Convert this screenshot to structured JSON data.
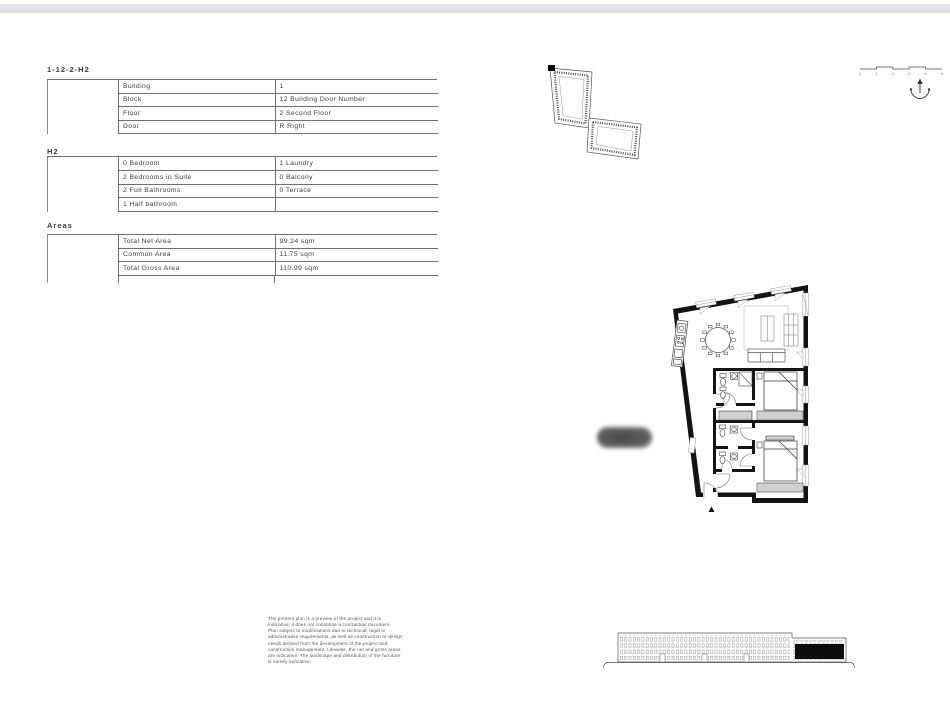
{
  "unit_table": {
    "title": "1-12-2-H2",
    "rows": [
      {
        "label": "Building",
        "value": "1"
      },
      {
        "label": "Block",
        "value": "12 Building Door Number"
      },
      {
        "label": "Floor",
        "value": "2 Second Floor"
      },
      {
        "label": "Door",
        "value": "R Right"
      }
    ]
  },
  "layout_table": {
    "title": "H2",
    "rows": [
      {
        "label": "0 Bedroom",
        "value": "1 Laundry"
      },
      {
        "label": "2 Bedrooms in Suite",
        "value": "0 Balcony"
      },
      {
        "label": "2 Full Bathrooms",
        "value": "0 Terrace"
      },
      {
        "label": "1 Half bathroom",
        "value": ""
      }
    ]
  },
  "areas_table": {
    "title": "Areas",
    "rows": [
      {
        "label": "Total Net Area",
        "value": "99.24 sqm"
      },
      {
        "label": "Common Area",
        "value": "11.75 sqm"
      },
      {
        "label": "Total Gross Area",
        "value": "110.99 sqm"
      }
    ]
  },
  "disclaimer": "The present plan is a preview of the project and it is\nindicative; it does not constitute a contractual document.\nPlan subject to modifications due to technical, legal or\nadministrative requirements, as well as construction or design\nneeds derived from the development of the project and\nconstruction management. Likewise, the net and gross areas\nare indicative. The landscape and distribution of the furniture\nis merely indicative.",
  "scale_bar": {
    "labels": [
      "0",
      "1",
      "2",
      "3",
      "4",
      "5"
    ]
  },
  "colors": {
    "ink": "#3d3d3d",
    "wall": "#141414",
    "highlight": "#0d0d0d",
    "band": "#e3e3e7"
  }
}
